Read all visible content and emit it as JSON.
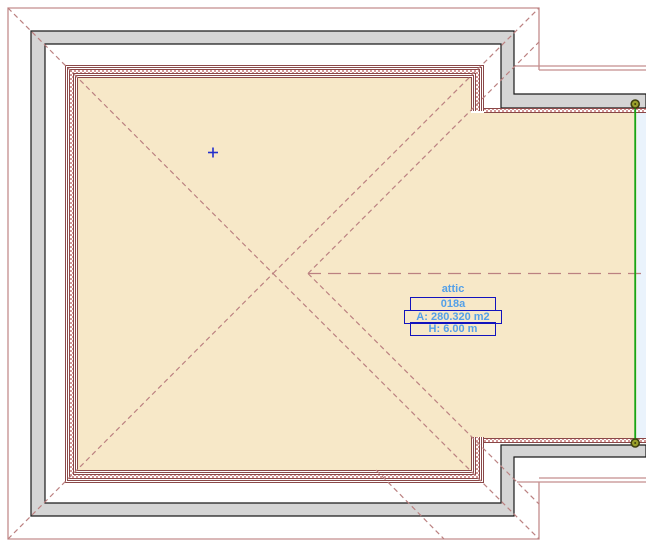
{
  "zone_stamp": {
    "name": "attic",
    "number": "018a",
    "area": "A: 280.320 m2",
    "height": "H: 6.00 m"
  },
  "colors": {
    "background": "#ffffff",
    "floor_fill": "#f7e8c8",
    "wall_fill": "#d5d5d5",
    "wall_outline": "#1a1a1a",
    "roof_line": "#c48d8d",
    "hidden_line": "#bb8181",
    "inner_wall_line": "#8a4848",
    "selection_green": "#17a517",
    "handle_olive": "#9aa02a",
    "stamp_border": "#1212bd",
    "stamp_text": "#54a0e8",
    "highlight_fill": "#eaf3fc",
    "cursor_blue": "#2330cc"
  }
}
